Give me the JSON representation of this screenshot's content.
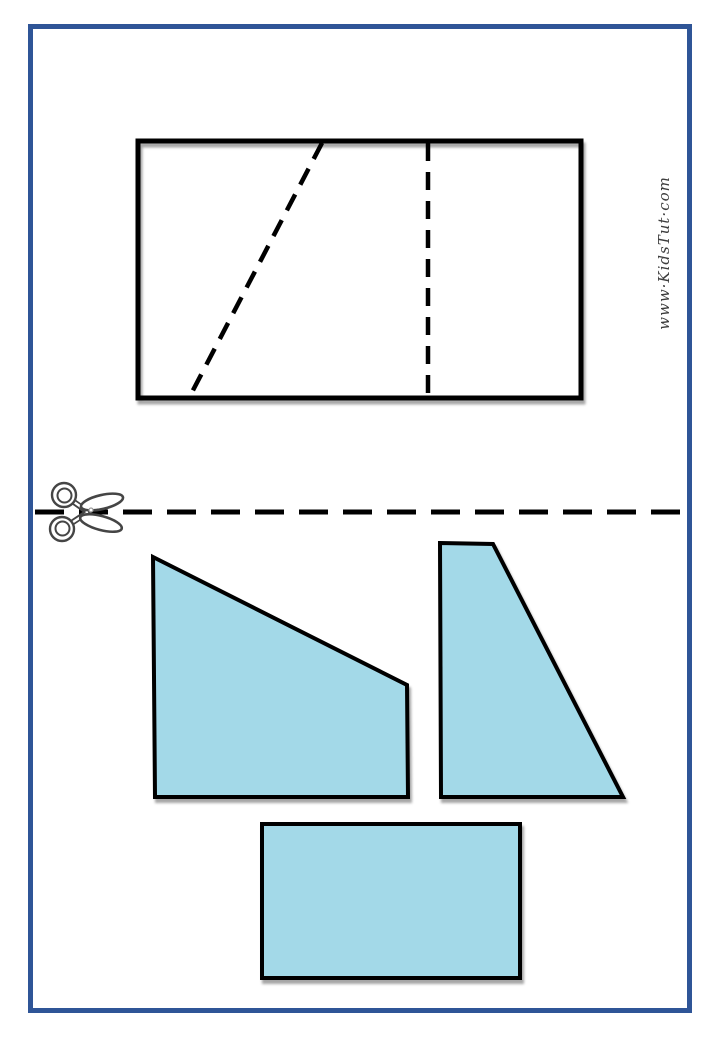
{
  "page": {
    "background_color": "#ffffff",
    "border_color": "#2F5597",
    "watermark_text": "www·KidsTut·com"
  },
  "puzzle_template": {
    "outline_color": "#000000",
    "outline_width": 5,
    "rect": {
      "x": 138,
      "y": 141,
      "width": 443,
      "height": 257
    },
    "guide_dash": "18 11",
    "guide_width": 4.5,
    "cut_guides": [
      {
        "x1": 322,
        "y1": 143,
        "x2": 190,
        "y2": 396
      },
      {
        "x1": 428,
        "y1": 143,
        "x2": 428,
        "y2": 396
      }
    ]
  },
  "cut_line": {
    "x1": 35,
    "x2": 684,
    "y": 512,
    "color": "#000000",
    "dash": "29 15",
    "thickness": 5
  },
  "scissors_icon": {
    "name": "scissors-icon",
    "x": 44,
    "y": 482,
    "outline_color": "#454545"
  },
  "pieces": {
    "fill_color": "#A3D9E8",
    "outline_color": "#000000",
    "outline_width": 4,
    "items": [
      {
        "name": "piece-quadrilateral",
        "points": "153,557 407,685 408,797 155,797"
      },
      {
        "name": "piece-right-trapezoid",
        "points": "440,543 493,544 623,797 441,797"
      },
      {
        "name": "piece-rectangle",
        "points": "262,824 520,824 520,978 262,978"
      }
    ]
  }
}
